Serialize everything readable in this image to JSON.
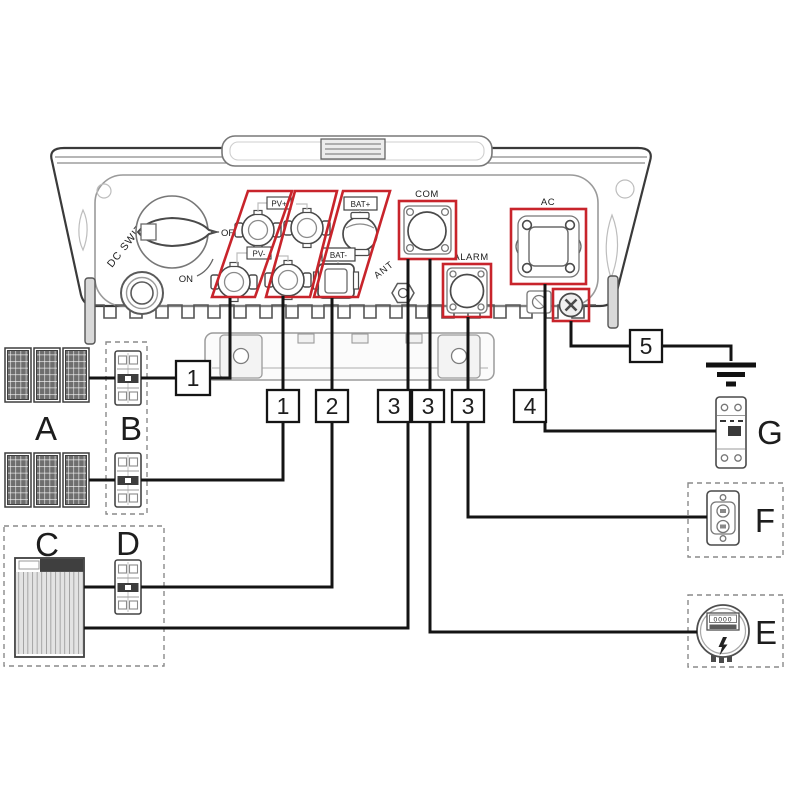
{
  "colors": {
    "highlight": "#c8242b",
    "wire": "#141414"
  },
  "inverter_ports": {
    "dc_switch": "DC SWITCH",
    "off": "OFF",
    "on": "ON",
    "pv_plus": "PV+",
    "pv_minus": "PV-",
    "bat_plus": "BAT+",
    "bat_minus": "BAT-",
    "com": "COM",
    "alarm": "ALARM",
    "ac": "AC",
    "ant": "ANT"
  },
  "callouts": {
    "pv_string_1": "1",
    "pv_string_2": "1",
    "battery_power": "2",
    "battery_com": "3",
    "meter_com": "3",
    "alarm_signal": "3",
    "ac_output": "4",
    "ground": "5"
  },
  "components": {
    "pv_array": "A",
    "pv_breakers": "B",
    "battery": "C",
    "battery_breaker": "D",
    "power_meter": "E",
    "signal_device": "F",
    "ac_breaker": "G"
  },
  "meter": {
    "display": "0000"
  }
}
